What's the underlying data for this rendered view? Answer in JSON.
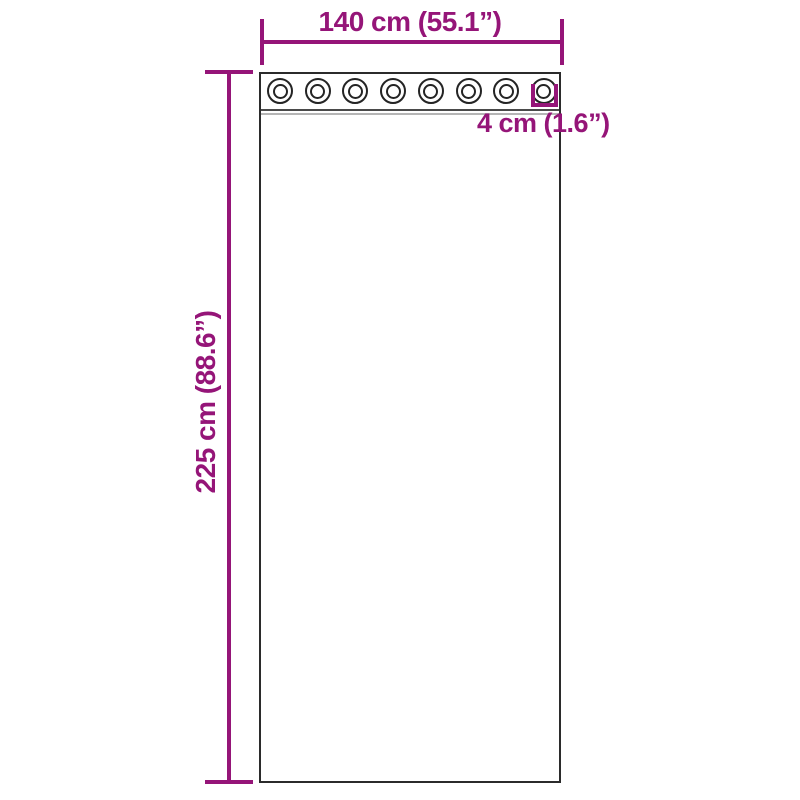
{
  "colors": {
    "accent": "#951578",
    "outline": "#2B2B2B",
    "seam_light": "#B5B5B5",
    "background": "#FFFFFF"
  },
  "diagram": {
    "width_label": "140 cm (55.1”)",
    "height_label": "225 cm (88.6”)",
    "grommet_diameter_label": "4 cm (1.6”)",
    "grommet_count": 8
  }
}
